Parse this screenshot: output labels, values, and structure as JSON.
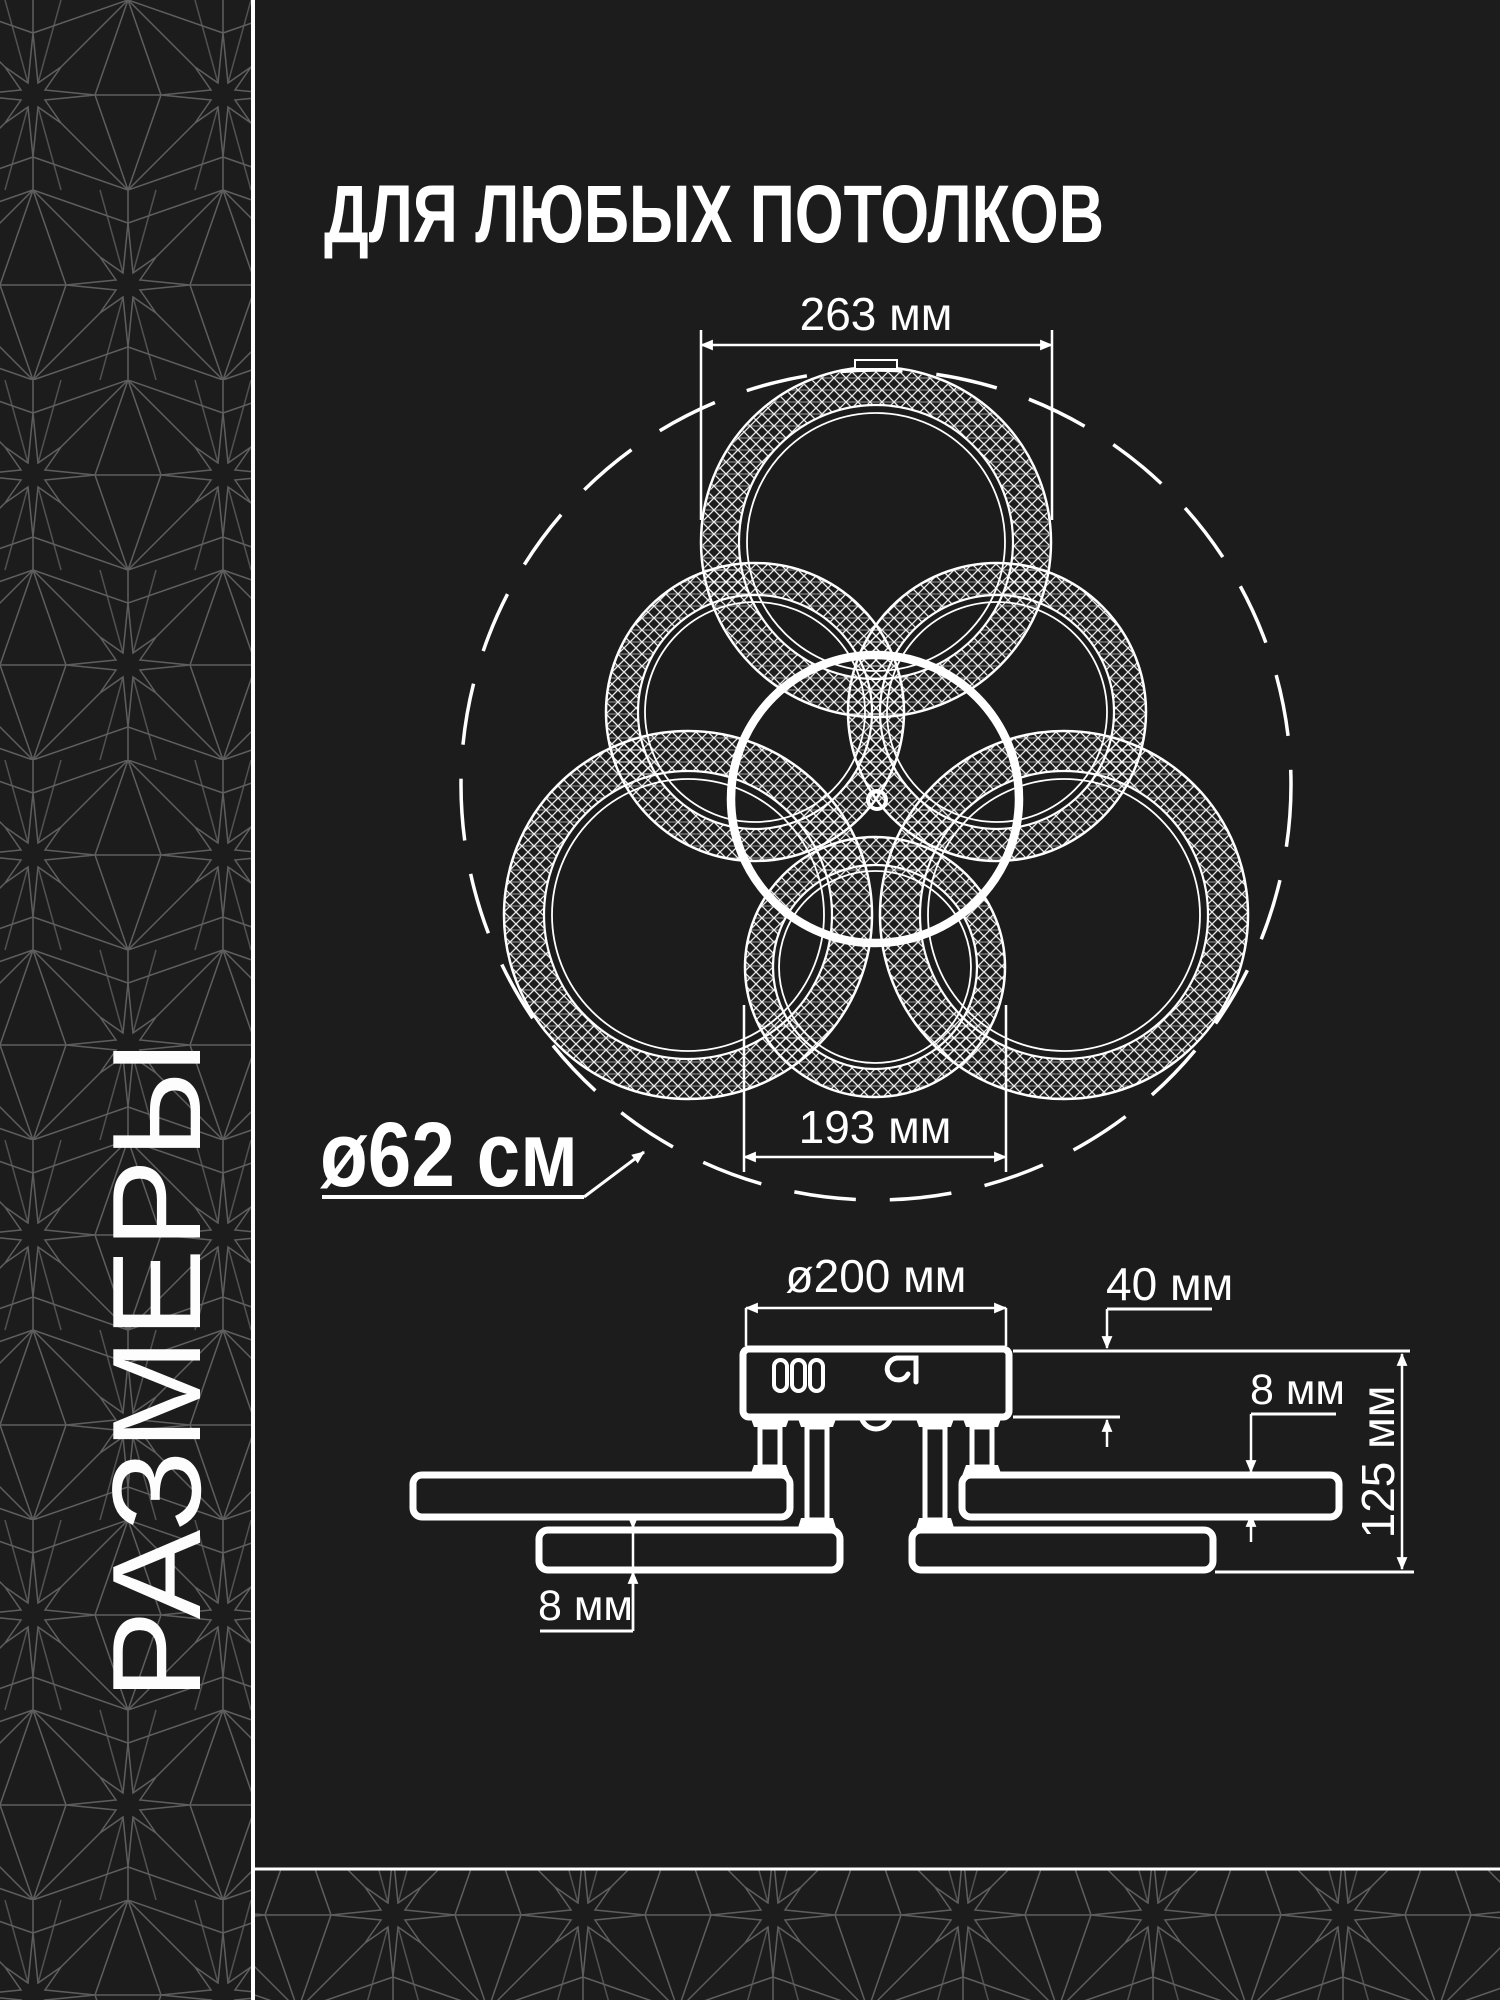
{
  "header": {
    "title": "ДЛЯ ЛЮБЫХ ПОТОЛКОВ"
  },
  "sidebar": {
    "vertical_label": "РАЗМЕРЫ"
  },
  "top_view": {
    "overall_diameter_label": "ø62 см",
    "top_ring_diameter": "263 мм",
    "bottom_ring_diameter": "193 мм"
  },
  "side_view": {
    "base_diameter": "ø200 мм",
    "base_height": "40 мм",
    "ring_thickness_right": "8 мм",
    "total_height": "125 мм",
    "ring_thickness_left": "8 мм"
  },
  "icons": {
    "vents": "vent-slots-icon",
    "hook": "wire-hook-icon"
  },
  "colors": {
    "background": "#1c1c1c",
    "foreground": "#ffffff",
    "pattern_line": "#5e5e5e"
  }
}
